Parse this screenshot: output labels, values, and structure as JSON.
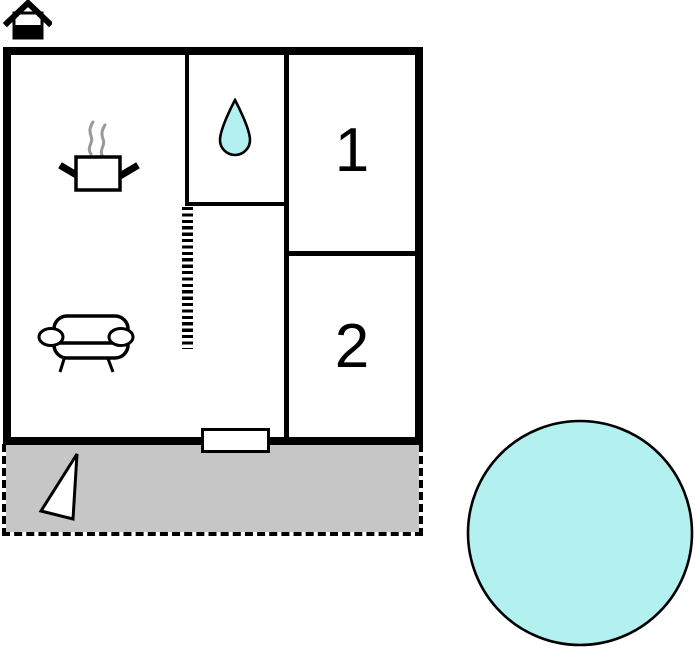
{
  "page": {
    "type": "floor-plan",
    "background": "#ffffff"
  },
  "colors": {
    "wall": "#000000",
    "water_fill": "#b3f0f0",
    "terrace_fill": "#c6c6c6",
    "steam": "#999999",
    "fixture_fill": "#ffffff"
  },
  "floor_indicator": {
    "icon": "house-icon"
  },
  "rooms": {
    "living_kitchen": {
      "icons": [
        "steam-pot-icon",
        "sofa-icon"
      ]
    },
    "bathroom": {
      "icon": "water-drop-icon"
    },
    "bedroom1": {
      "label": "1"
    },
    "bedroom2": {
      "label": "2"
    }
  },
  "features": {
    "sliding_partition": "hatched-line",
    "entrance_door": "door-rectangle",
    "terrace": {
      "icon": "flag-triangle-icon"
    },
    "pool": {
      "icon": "pool-circle"
    }
  }
}
